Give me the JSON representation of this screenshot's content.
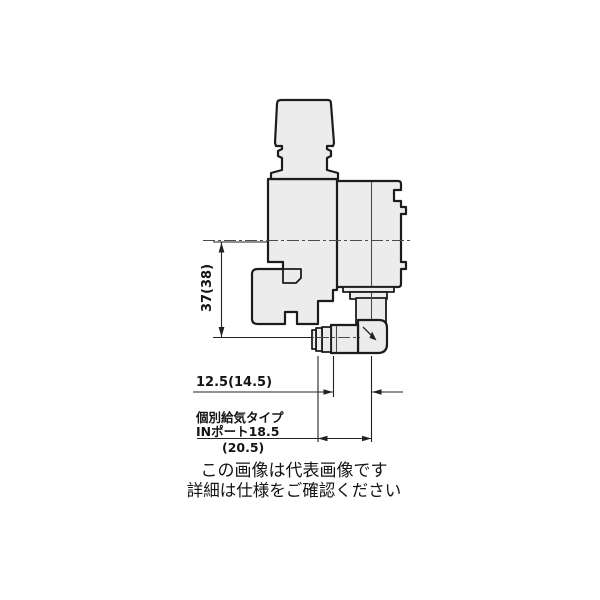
{
  "drawing": {
    "dimensions": {
      "vertical": "37(38)",
      "horizontal": "12.5(14.5)",
      "port_note_line1": "個別給気タイプ",
      "port_note_line2": "INポート18.5",
      "port_note_line3": "(20.5)"
    },
    "colors": {
      "outline": "#1c1c1c",
      "body_fill": "#ececec",
      "dimension_line": "#222222",
      "background": "#ffffff"
    }
  },
  "caption": {
    "line1": "この画像は代表画像です",
    "line2": "詳細は仕様をご確認ください"
  }
}
